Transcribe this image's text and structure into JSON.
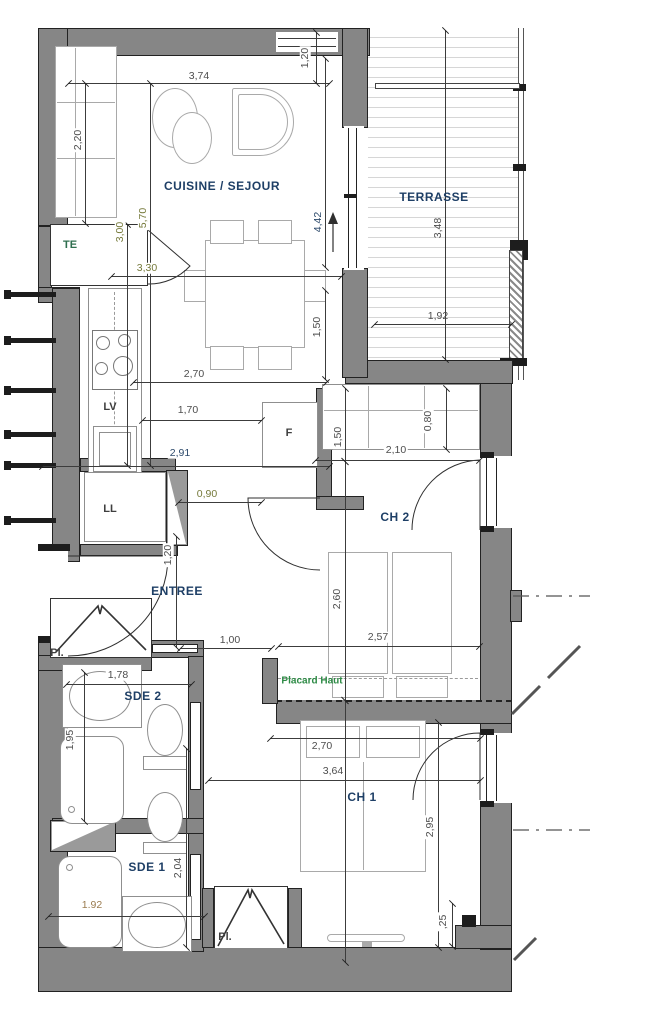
{
  "rooms": {
    "cuisine_sejour": "CUISINE / SEJOUR",
    "terrasse": "TERRASSE",
    "ch2": "CH 2",
    "entree": "ENTREE",
    "sde2": "SDE 2",
    "sde1": "SDE 1",
    "ch1": "CH 1"
  },
  "features": {
    "te": "TE",
    "lv": "LV",
    "ll": "LL",
    "f": "F",
    "pl_entree": "Pl.",
    "pl_ch1": "Pl.",
    "placard_haut": "Placard Haut"
  },
  "dimensions": {
    "d374": "3,74",
    "d120_top": "1,20",
    "d220": "2,20",
    "d570": "5,70",
    "d300": "3,00",
    "d330": "3,30",
    "d442": "4,42",
    "d348": "3,48",
    "d192_terrasse": "1,92",
    "d150_table": "1,50",
    "d270_table": "2,70",
    "d170": "1,70",
    "d291": "2,91",
    "d150_ch2": "1,50",
    "d080": "0,80",
    "d210": "2,10",
    "d090": "0,90",
    "d120_entree": "1,20",
    "d100": "1,00",
    "d260": "2,60",
    "d257": "2,57",
    "d178": "1,78",
    "d195": "1,95",
    "d270_ch1": "2,70",
    "d364": "3,64",
    "d295": "2,95",
    "d204": "2,04",
    "d192_sde1": "1.92",
    "d025": ",25"
  },
  "colors": {
    "wall": "#868686",
    "outline": "#1d1d1d",
    "room_label": "#1e3f66",
    "feature_label": "#3f3f3f",
    "closet_label": "#2e8b46",
    "dimension": "#4d4d4d",
    "dimension_alt": "#75793a",
    "furniture": "#a9a9a9",
    "deck_line": "#d6d6d6"
  }
}
